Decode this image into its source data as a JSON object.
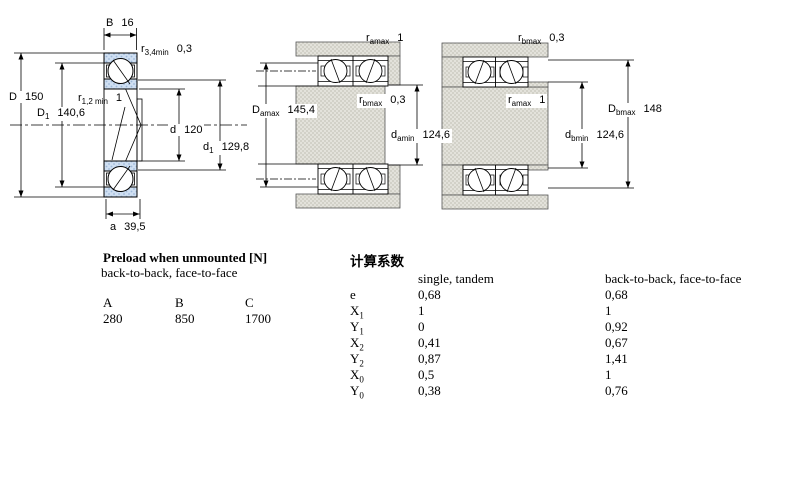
{
  "diagrams": {
    "left": {
      "B": {
        "sym": "B",
        "val": "16"
      },
      "r34": {
        "sym": "r",
        "sub": "3,4min",
        "val": "0,3"
      },
      "r12": {
        "sym": "r",
        "sub": "1,2 min",
        "val": "1"
      },
      "D": {
        "sym": "D",
        "val": "150"
      },
      "D1": {
        "sym": "D",
        "sub": "1",
        "val": "140,6"
      },
      "d": {
        "sym": "d",
        "val": "120"
      },
      "d1": {
        "sym": "d",
        "sub": "1",
        "val": "129,8"
      },
      "a": {
        "sym": "a",
        "val": "39,5"
      }
    },
    "middle": {
      "ramax": {
        "sym": "r",
        "sub": "amax",
        "val": "1"
      },
      "Damax": {
        "sym": "D",
        "sub": "amax",
        "val": "145,4"
      },
      "rbmax": {
        "sym": "r",
        "sub": "bmax",
        "val": "0,3"
      },
      "damin": {
        "sym": "d",
        "sub": "amin",
        "val": "124,6"
      }
    },
    "right": {
      "rbmax": {
        "sym": "r",
        "sub": "bmax",
        "val": "0,3"
      },
      "ramax": {
        "sym": "r",
        "sub": "amax",
        "val": "1"
      },
      "Dbmax": {
        "sym": "D",
        "sub": "bmax",
        "val": "148"
      },
      "dbmin": {
        "sym": "d",
        "sub": "bmin",
        "val": "124,6"
      }
    }
  },
  "preload": {
    "title": "Preload when unmounted [N]",
    "subtitle": "back-to-back, face-to-face",
    "cols": [
      "A",
      "B",
      "C"
    ],
    "vals": [
      "280",
      "850",
      "1700"
    ]
  },
  "factors": {
    "title": "计算系数",
    "h1": "single, tandem",
    "h2": "back-to-back, face-to-face",
    "rows": [
      {
        "sym": "e",
        "sub": "",
        "v1": "0,68",
        "v2": "0,68"
      },
      {
        "sym": "X",
        "sub": "1",
        "v1": "1",
        "v2": "1"
      },
      {
        "sym": "Y",
        "sub": "1",
        "v1": "0",
        "v2": "0,92"
      },
      {
        "sym": "X",
        "sub": "2",
        "v1": "0,41",
        "v2": "0,67"
      },
      {
        "sym": "Y",
        "sub": "2",
        "v1": "0,87",
        "v2": "1,41"
      },
      {
        "sym": "X",
        "sub": "0",
        "v1": "0,5",
        "v2": "1"
      },
      {
        "sym": "Y",
        "sub": "0",
        "v1": "0,38",
        "v2": "0,76"
      }
    ]
  },
  "colors": {
    "ring_blue": "#cfdff2",
    "ring_blue_dot": "#9db8d9",
    "steel_gray": "#d9d8d0",
    "line": "#000000"
  }
}
